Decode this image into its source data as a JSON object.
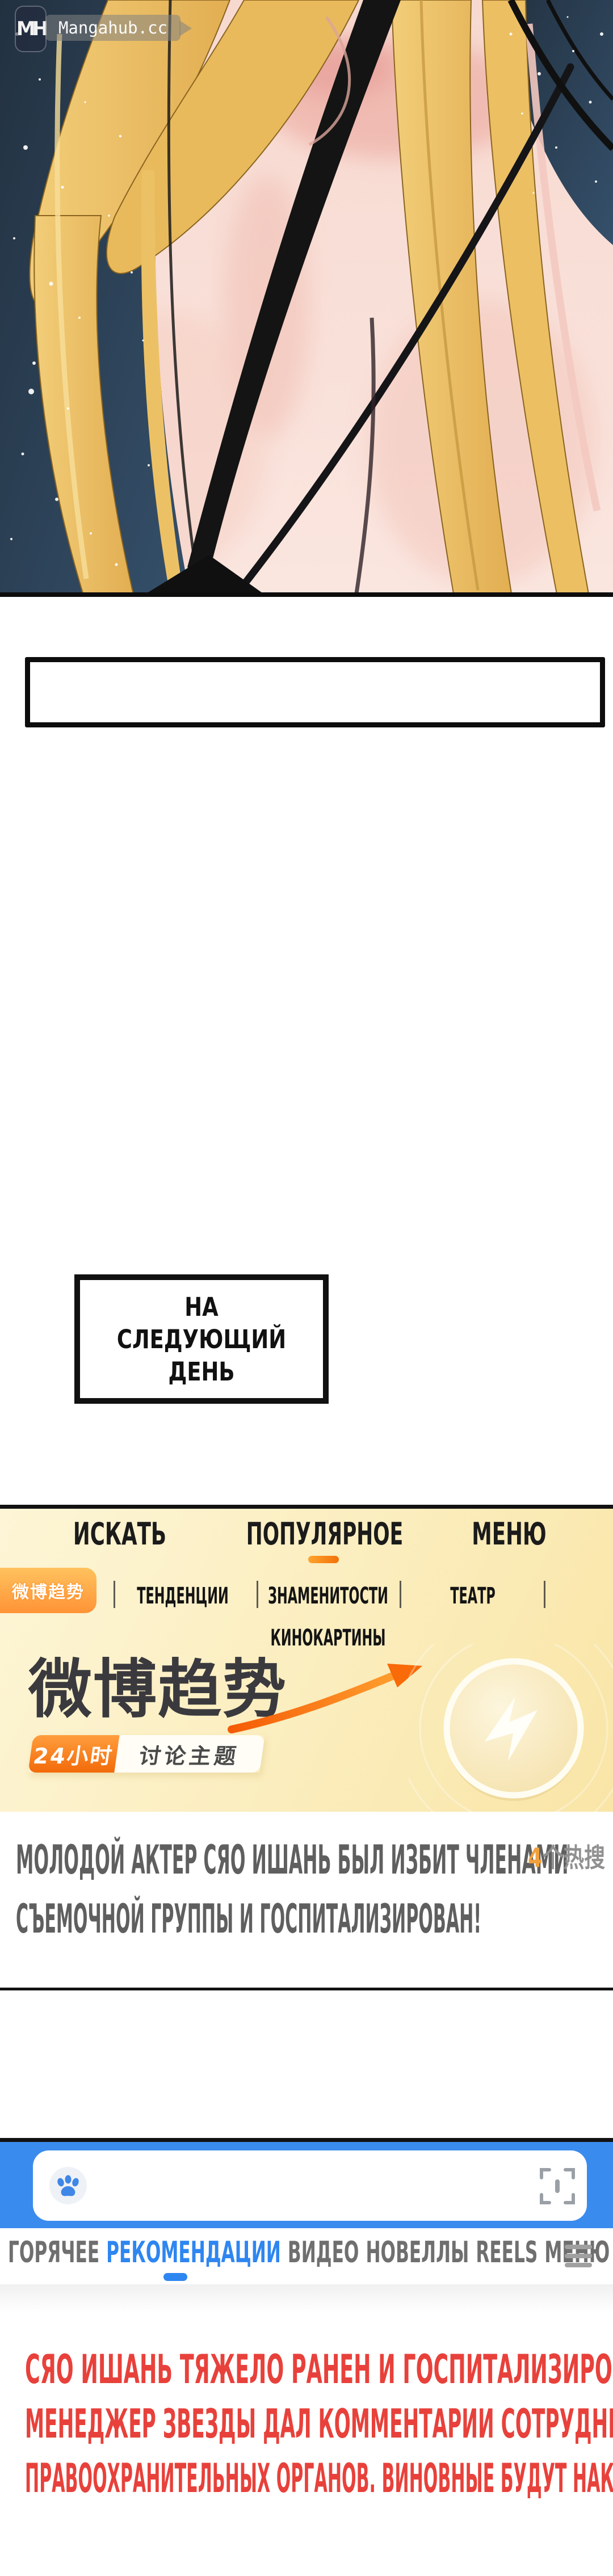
{
  "watermark": {
    "logo_text": "MH",
    "site": "Mangahub.cc"
  },
  "captions": {
    "next_day_line1": "НА СЛЕДУЮЩИЙ",
    "next_day_line2": "ДЕНЬ"
  },
  "weibo_app": {
    "top_tabs": [
      {
        "label": "ИСКАТЬ",
        "active": false
      },
      {
        "label": "ПОПУЛЯРНОЕ",
        "active": true
      },
      {
        "label": "МЕНЮ",
        "active": false
      }
    ],
    "trend_badge_cn": "微博趋势",
    "sub_tabs": [
      {
        "label": "ТЕНДЕНЦИИ"
      },
      {
        "label": "ЗНАМЕНИТОСТИ"
      },
      {
        "label": "ТЕАТР"
      },
      {
        "label": "КИНОКАРТИНЫ"
      }
    ],
    "banner": {
      "title_cn": "微博趋势",
      "tag_time_cn": "24小时",
      "tag_topic_cn": "讨论主题"
    },
    "hot_count_number": "4",
    "hot_count_suffix": "个热搜",
    "headline_line1": "МОЛОДОЙ АКТЕР СЯО ИШАНЬ БЫЛ ИЗБИТ ЧЛЕНАМИ",
    "headline_line2": "СЪЕМОЧНОЙ ГРУППЫ И ГОСПИТАЛИЗИРОВАН!"
  },
  "search_app": {
    "search_value": "",
    "tabs": [
      {
        "label": "ГОРЯЧЕЕ",
        "active": false
      },
      {
        "label": "РЕКОМЕНДАЦИИ",
        "active": true
      },
      {
        "label": "ВИДЕО",
        "active": false
      },
      {
        "label": "НОВЕЛЛЫ",
        "active": false
      },
      {
        "label": "REELS",
        "active": false
      },
      {
        "label": "МЕНЮ",
        "active": false
      }
    ]
  },
  "narration": {
    "line1": "СЯО ИШАНЬ ТЯЖЕЛО РАНЕН И ГОСПИТАЛИЗИРОВАН,",
    "line2": "МЕНЕДЖЕР ЗВЕЗДЫ ДАЛ КОММЕНТАРИИ СОТРУДНИКАМ",
    "line3": "ПРАВООХРАНИТЕЛЬНЫХ ОРГАНОВ. ВИНОВНЫЕ БУДУТ НАКАЗАНЫ!"
  },
  "colors": {
    "accent_orange": "#f2720a",
    "accent_blue": "#2e86f0",
    "narration_red": "#e8413b",
    "panel_cream": "#fbedbd"
  }
}
